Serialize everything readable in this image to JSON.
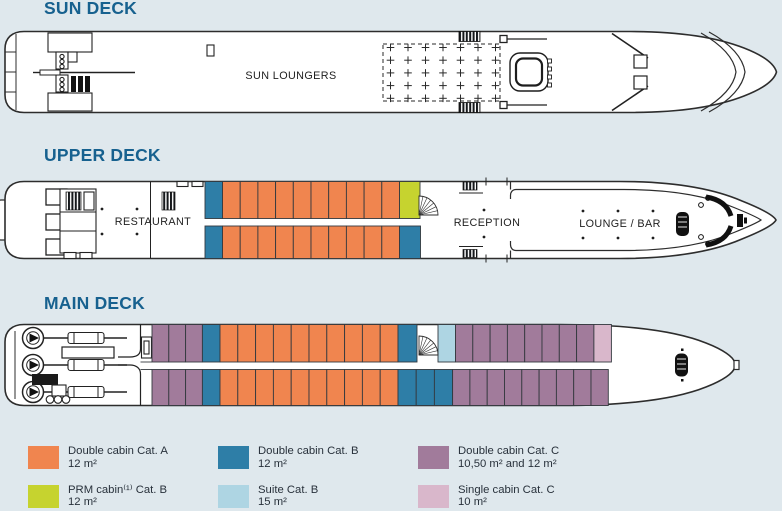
{
  "page": {
    "background": "#dfe8ed",
    "title_color": "#17618f",
    "text_color": "#28313b",
    "hull_outline": "#2d2d2d"
  },
  "decks": [
    {
      "id": "sun",
      "title": "SUN DECK",
      "labels": {
        "sun_loungers": "SUN LOUNGERS"
      }
    },
    {
      "id": "upper",
      "title": "UPPER DECK",
      "labels": {
        "restaurant": "RESTAURANT",
        "reception": "RECEPTION",
        "lounge_bar": "LOUNGE / BAR"
      },
      "cabin_rows": [
        {
          "x": 205,
          "y": 181.5,
          "h": 37,
          "segments": [
            {
              "cat": "B",
              "count": 1,
              "w": 17.5
            },
            {
              "cat": "A",
              "count": 10,
              "w": 17.7
            },
            {
              "cat": "PRM",
              "count": 1,
              "w": 20.5
            }
          ]
        },
        {
          "x": 205,
          "y": 226,
          "h": 32.5,
          "segments": [
            {
              "cat": "B",
              "count": 1,
              "w": 17.5
            },
            {
              "cat": "A",
              "count": 10,
              "w": 17.7
            },
            {
              "cat": "B",
              "count": 1,
              "w": 21
            }
          ]
        }
      ]
    },
    {
      "id": "main",
      "title": "MAIN DECK",
      "labels": {},
      "cabin_rows": [
        {
          "x": 152,
          "y": 324.5,
          "h": 37.5,
          "segments": [
            {
              "cat": "C",
              "count": 3,
              "w": 16.8
            },
            {
              "cat": "B",
              "count": 1,
              "w": 17.6
            },
            {
              "cat": "A",
              "count": 10,
              "w": 17.8
            },
            {
              "cat": "B",
              "count": 1,
              "w": 19
            },
            {
              "gap": true,
              "count": 1,
              "w": 21
            },
            {
              "cat": "SUITE",
              "count": 1,
              "w": 17.5
            },
            {
              "cat": "C",
              "count": 8,
              "w": 17.3
            },
            {
              "cat": "C1",
              "count": 1,
              "w": 17.5
            }
          ]
        },
        {
          "x": 152,
          "y": 369.5,
          "h": 36,
          "segments": [
            {
              "cat": "C",
              "count": 3,
              "w": 16.8
            },
            {
              "cat": "B",
              "count": 1,
              "w": 17.6
            },
            {
              "cat": "A",
              "count": 10,
              "w": 17.8
            },
            {
              "cat": "B",
              "count": 3,
              "w": 18.2
            },
            {
              "cat": "C",
              "count": 9,
              "w": 17.3
            }
          ]
        }
      ]
    }
  ],
  "legend": {
    "items": [
      {
        "cat": "A",
        "color": "#f0854f",
        "label": "Double cabin Cat. A",
        "size": "12 m²"
      },
      {
        "cat": "B",
        "color": "#2e7ea7",
        "label": "Double cabin Cat. B",
        "size": "12 m²"
      },
      {
        "cat": "C",
        "color": "#a17b9b",
        "label": "Double cabin Cat. C",
        "size": "10,50 m² and 12 m²"
      },
      {
        "cat": "PRM",
        "color": "#c6d32f",
        "label": "PRM cabin⁽¹⁾ Cat. B",
        "size": "12 m²"
      },
      {
        "cat": "SUITE",
        "color": "#aed5e3",
        "label": "Suite Cat. B",
        "size": "15 m²"
      },
      {
        "cat": "C1",
        "color": "#d9b7cb",
        "label": "Single cabin Cat. C",
        "size": "10 m²"
      }
    ]
  }
}
